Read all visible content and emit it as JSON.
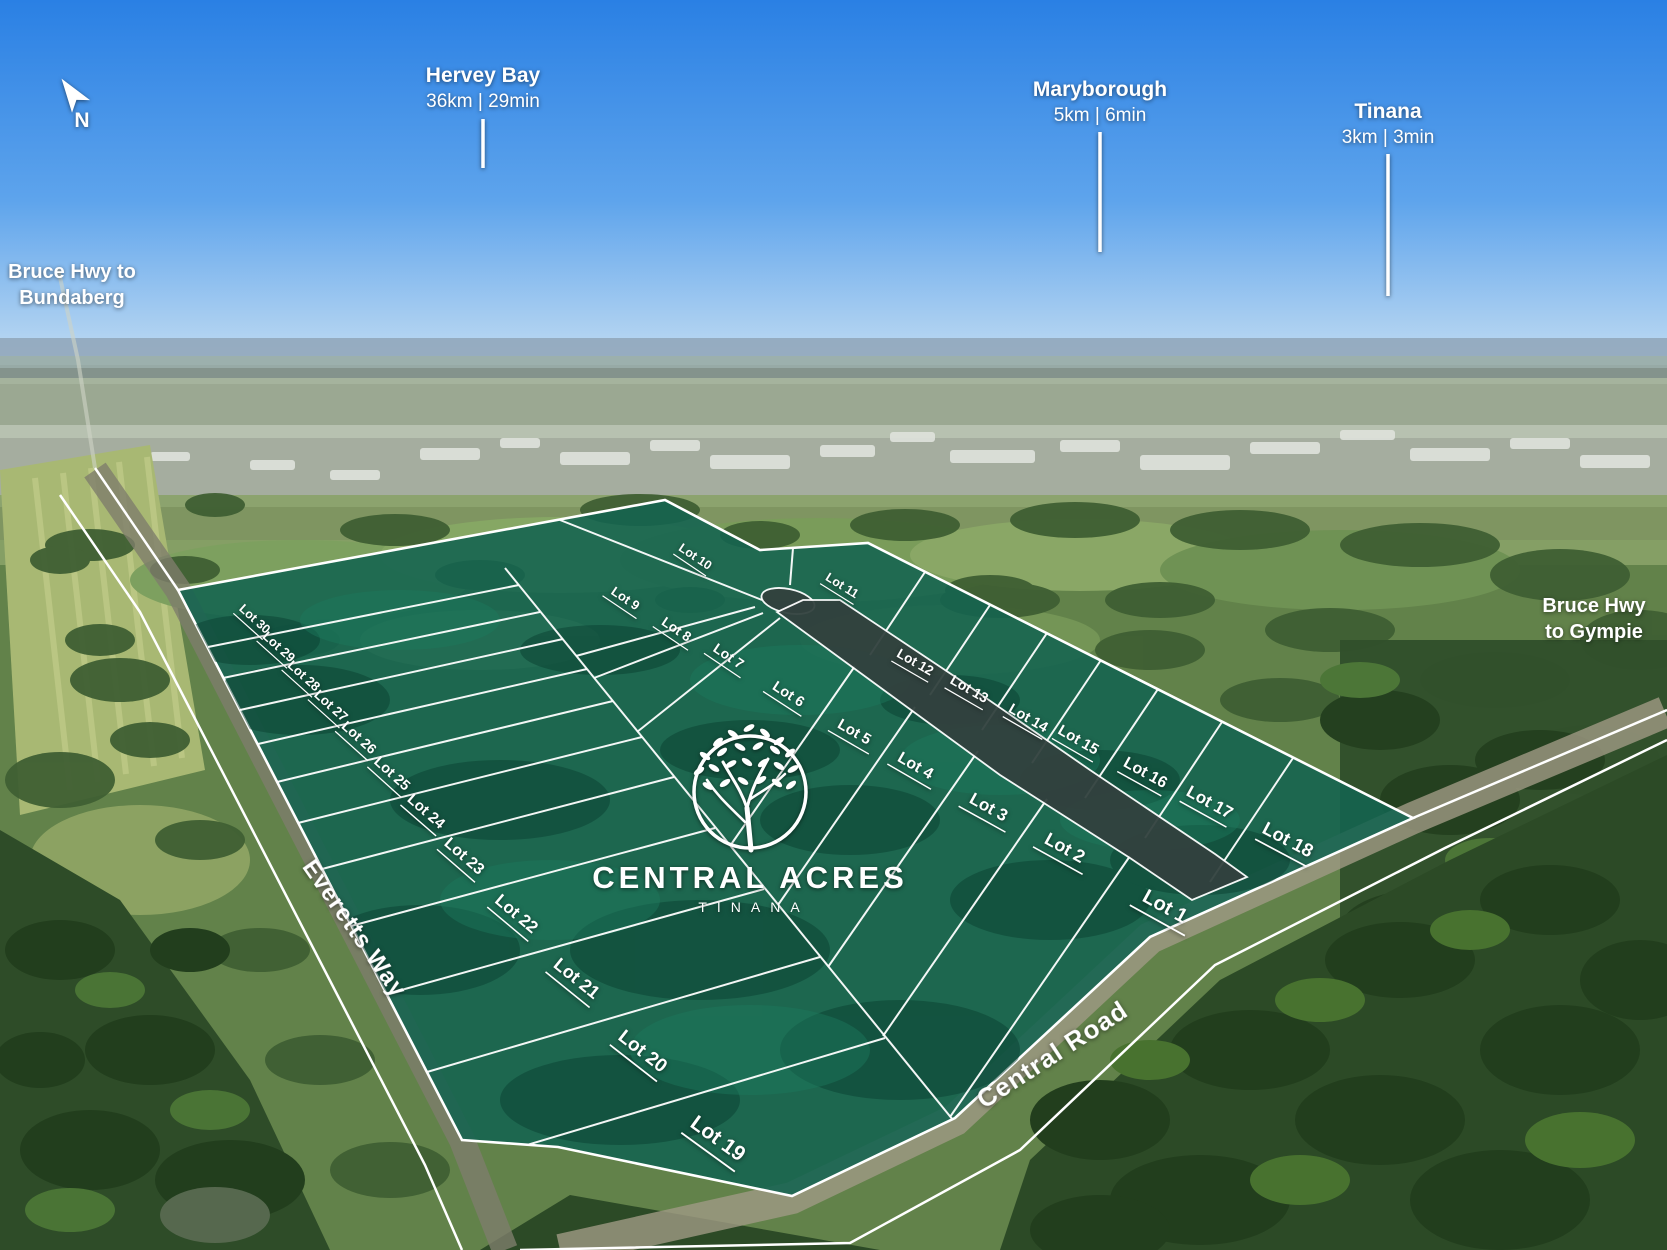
{
  "compass": {
    "label": "N"
  },
  "destinations": [
    {
      "name": "Hervey Bay",
      "distance": "36km | 29min",
      "x": 483,
      "name_y": 82,
      "line_y1": 119,
      "line_y2": 168
    },
    {
      "name": "Maryborough",
      "distance": "5km | 6min",
      "x": 1100,
      "name_y": 96,
      "line_y1": 132,
      "line_y2": 252
    },
    {
      "name": "Tinana",
      "distance": "3km | 3min",
      "x": 1388,
      "name_y": 118,
      "line_y1": 154,
      "line_y2": 296
    }
  ],
  "highways": {
    "bundaberg": {
      "line1": "Bruce Hwy to",
      "line2": "Bundaberg",
      "x": 72,
      "y1": 278,
      "y2": 304
    },
    "gympie": {
      "line1": "Bruce Hwy",
      "line2": "to Gympie",
      "x": 1594,
      "y1": 612,
      "y2": 638
    }
  },
  "streets": {
    "everetts": {
      "name": "Everetts Way",
      "x": 348,
      "y": 933,
      "rotate": 55,
      "size": 24
    },
    "central": {
      "name": "Central Road",
      "x": 1057,
      "y": 1062,
      "rotate": -33,
      "size": 26
    }
  },
  "logo": {
    "title": "CENTRAL ACRES",
    "subtitle": "TINANA"
  },
  "colors": {
    "estate_overlay": "#136350",
    "internal_road": "#32413e",
    "boundary_line": "#ffffff"
  },
  "lots": [
    {
      "label": "Lot 1",
      "x": 1162,
      "y": 912,
      "rotate": 29,
      "size": 20
    },
    {
      "label": "Lot 2",
      "x": 1062,
      "y": 853,
      "rotate": 29,
      "size": 18
    },
    {
      "label": "Lot 3",
      "x": 986,
      "y": 812,
      "rotate": 29,
      "size": 17
    },
    {
      "label": "Lot 4",
      "x": 913,
      "y": 770,
      "rotate": 30,
      "size": 16
    },
    {
      "label": "Lot 5",
      "x": 852,
      "y": 736,
      "rotate": 30,
      "size": 15
    },
    {
      "label": "Lot 6",
      "x": 786,
      "y": 698,
      "rotate": 33,
      "size": 14.5
    },
    {
      "label": "Lot 7",
      "x": 726,
      "y": 660,
      "rotate": 34,
      "size": 14
    },
    {
      "label": "Lot 8",
      "x": 674,
      "y": 633,
      "rotate": 34,
      "size": 13.5
    },
    {
      "label": "Lot 9",
      "x": 623,
      "y": 602,
      "rotate": 34,
      "size": 13
    },
    {
      "label": "Lot 10",
      "x": 693,
      "y": 560,
      "rotate": 34,
      "size": 12.5
    },
    {
      "label": "Lot 11",
      "x": 840,
      "y": 589,
      "rotate": 32,
      "size": 12.5
    },
    {
      "label": "Lot 12",
      "x": 913,
      "y": 666,
      "rotate": 30,
      "size": 13.5
    },
    {
      "label": "Lot 13",
      "x": 967,
      "y": 693,
      "rotate": 30,
      "size": 14
    },
    {
      "label": "Lot 14",
      "x": 1026,
      "y": 722,
      "rotate": 30,
      "size": 14.5
    },
    {
      "label": "Lot 15",
      "x": 1076,
      "y": 744,
      "rotate": 30,
      "size": 15
    },
    {
      "label": "Lot 16",
      "x": 1143,
      "y": 777,
      "rotate": 29,
      "size": 16
    },
    {
      "label": "Lot 17",
      "x": 1207,
      "y": 807,
      "rotate": 29,
      "size": 17
    },
    {
      "label": "Lot 18",
      "x": 1285,
      "y": 845,
      "rotate": 28,
      "size": 18.5
    },
    {
      "label": "Lot 19",
      "x": 714,
      "y": 1144,
      "rotate": 36,
      "size": 21
    },
    {
      "label": "Lot 20",
      "x": 639,
      "y": 1056,
      "rotate": 38,
      "size": 19
    },
    {
      "label": "Lot 21",
      "x": 573,
      "y": 983,
      "rotate": 39,
      "size": 18
    },
    {
      "label": "Lot 22",
      "x": 513,
      "y": 918,
      "rotate": 40,
      "size": 17
    },
    {
      "label": "Lot 23",
      "x": 461,
      "y": 860,
      "rotate": 41,
      "size": 16
    },
    {
      "label": "Lot 24",
      "x": 423,
      "y": 815,
      "rotate": 41,
      "size": 15
    },
    {
      "label": "Lot 25",
      "x": 389,
      "y": 777,
      "rotate": 42,
      "size": 14.5
    },
    {
      "label": "Lot 26",
      "x": 356,
      "y": 741,
      "rotate": 42,
      "size": 14
    },
    {
      "label": "Lot 27",
      "x": 328,
      "y": 709,
      "rotate": 42,
      "size": 13.5
    },
    {
      "label": "Lot 28",
      "x": 301,
      "y": 679,
      "rotate": 42,
      "size": 13
    },
    {
      "label": "Lot 29",
      "x": 276,
      "y": 650,
      "rotate": 42,
      "size": 13
    },
    {
      "label": "Lot 30",
      "x": 252,
      "y": 622,
      "rotate": 42,
      "size": 12.5
    }
  ]
}
